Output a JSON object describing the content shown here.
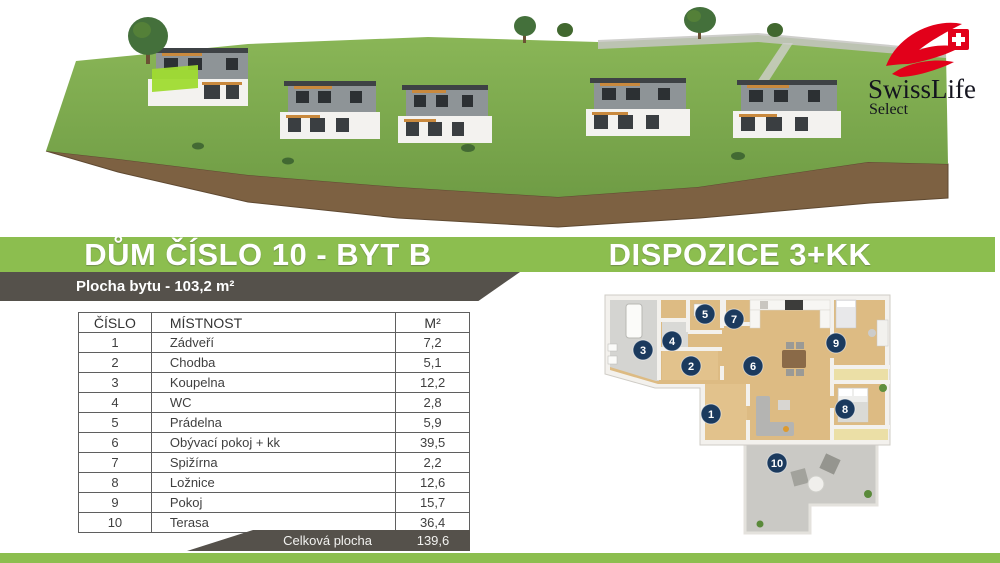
{
  "theme": {
    "green": "#8cbe4f",
    "dark": "#55514b",
    "badge": "#1b3a5e",
    "red": "#e2001a",
    "hl": "#9fdb30"
  },
  "logo": {
    "brand": "SwissLife",
    "sub": "Select"
  },
  "header": {
    "title_left": "DŮM ČÍSLO 10 - BYT B",
    "title_right": "DISPOZICE 3+KK",
    "subtitle": "Plocha bytu - 103,2 m²"
  },
  "room_table": {
    "headers": [
      "ČÍSLO",
      "MÍSTNOST",
      "M²"
    ],
    "rows": [
      [
        "1",
        "Zádveří",
        "7,2"
      ],
      [
        "2",
        "Chodba",
        "5,1"
      ],
      [
        "3",
        "Koupelna",
        "12,2"
      ],
      [
        "4",
        "WC",
        "2,8"
      ],
      [
        "5",
        "Prádelna",
        "5,9"
      ],
      [
        "6",
        "Obývací pokoj + kk",
        "39,5"
      ],
      [
        "7",
        "Spižírna",
        "2,2"
      ],
      [
        "8",
        "Ložnice",
        "12,6"
      ],
      [
        "9",
        "Pokoj",
        "15,7"
      ],
      [
        "10",
        "Terasa",
        "36,4"
      ]
    ],
    "total_label": "Celková plocha",
    "total_value": "139,6"
  },
  "floorplan": {
    "badges": [
      {
        "n": "1",
        "x": 111,
        "y": 126
      },
      {
        "n": "2",
        "x": 91,
        "y": 78
      },
      {
        "n": "3",
        "x": 43,
        "y": 62
      },
      {
        "n": "4",
        "x": 72,
        "y": 53
      },
      {
        "n": "5",
        "x": 105,
        "y": 26
      },
      {
        "n": "6",
        "x": 153,
        "y": 78
      },
      {
        "n": "7",
        "x": 134,
        "y": 31
      },
      {
        "n": "8",
        "x": 245,
        "y": 121
      },
      {
        "n": "9",
        "x": 236,
        "y": 55
      },
      {
        "n": "10",
        "x": 177,
        "y": 175
      }
    ]
  }
}
